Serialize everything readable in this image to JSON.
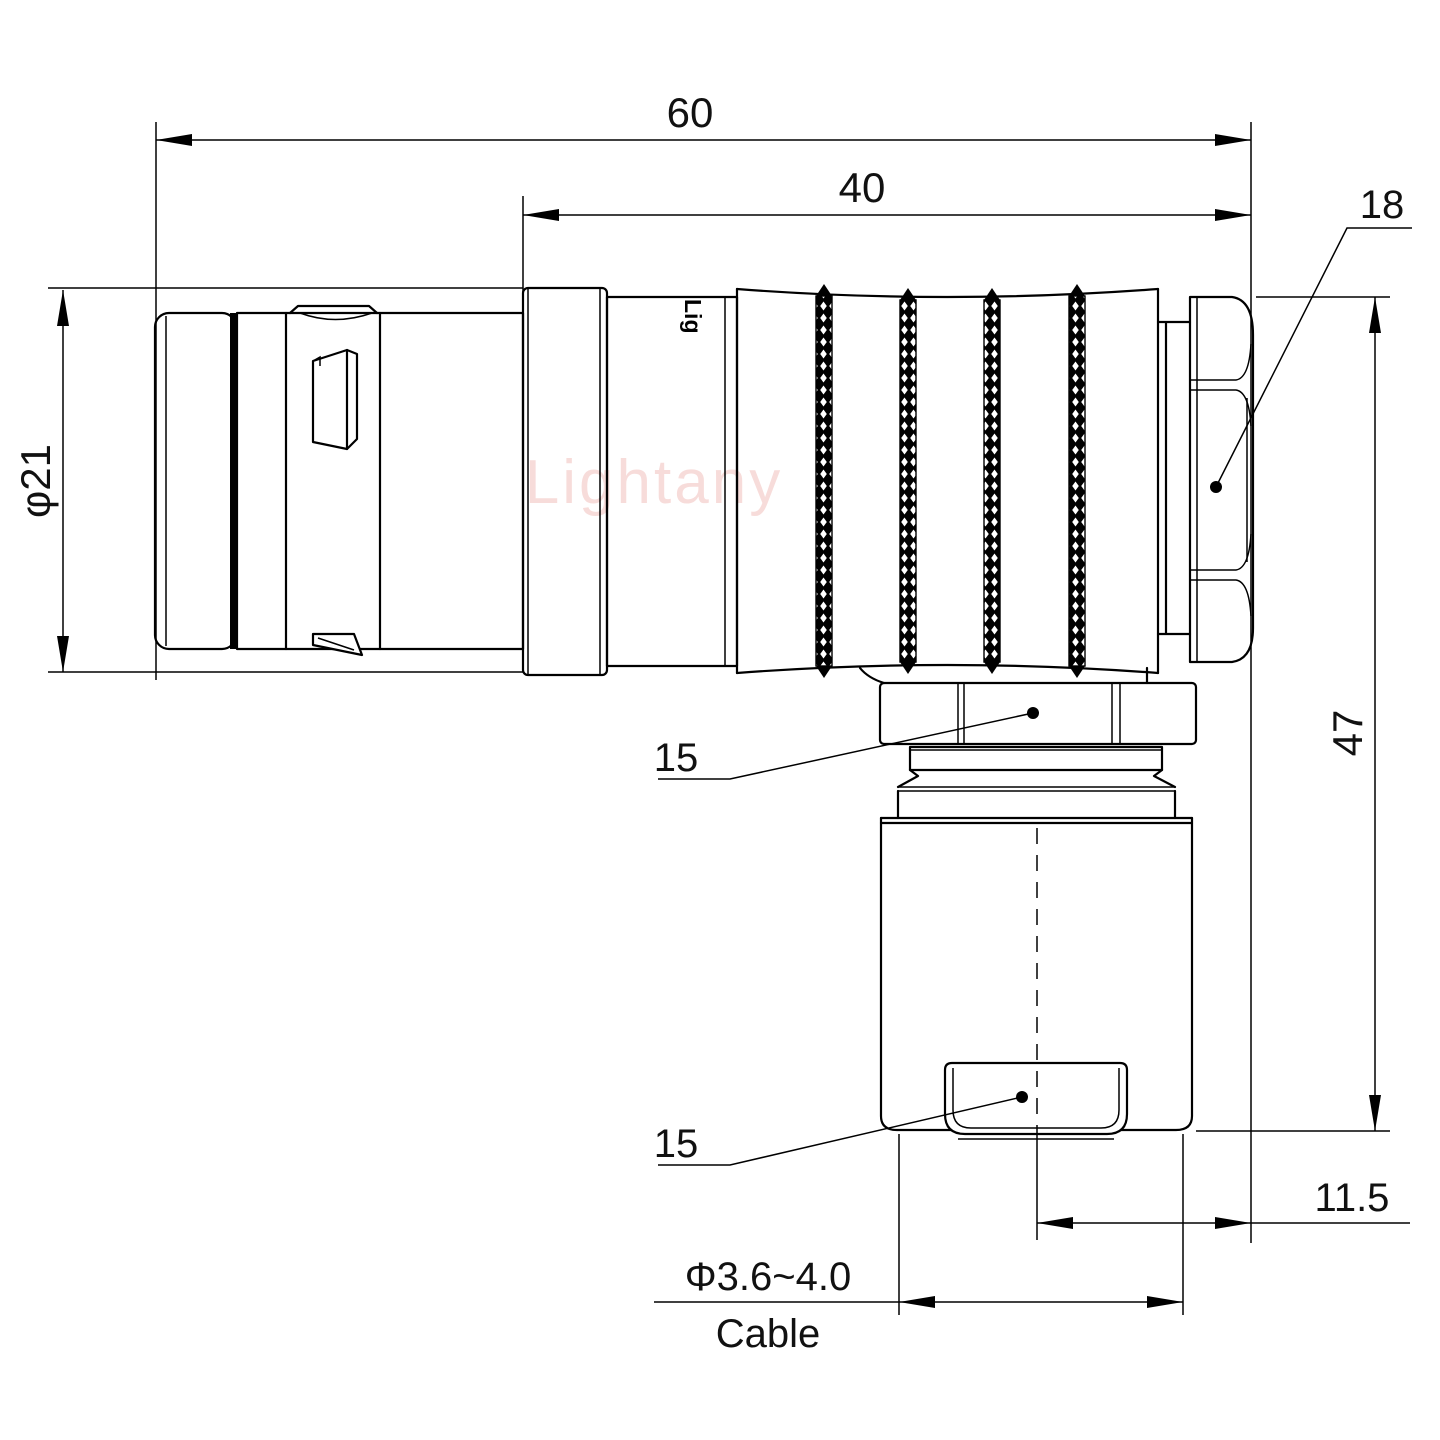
{
  "watermark": {
    "text": "Lightany",
    "color": "#f2c0bc"
  },
  "body_markings": {
    "logo": "Lig"
  },
  "dimensions": {
    "overall_length": "60",
    "rear_length": "40",
    "backnut_flats": "18",
    "front_diameter": "φ21",
    "overall_height": "47",
    "elbow_nut": "15",
    "cable_clamp": "15",
    "side_offset": "11.5",
    "cable_diameter": "Φ3.6~4.0",
    "cable_word": "Cable"
  },
  "colors": {
    "line": "#000000",
    "background": "#ffffff",
    "watermark": "#f2c0bc"
  }
}
